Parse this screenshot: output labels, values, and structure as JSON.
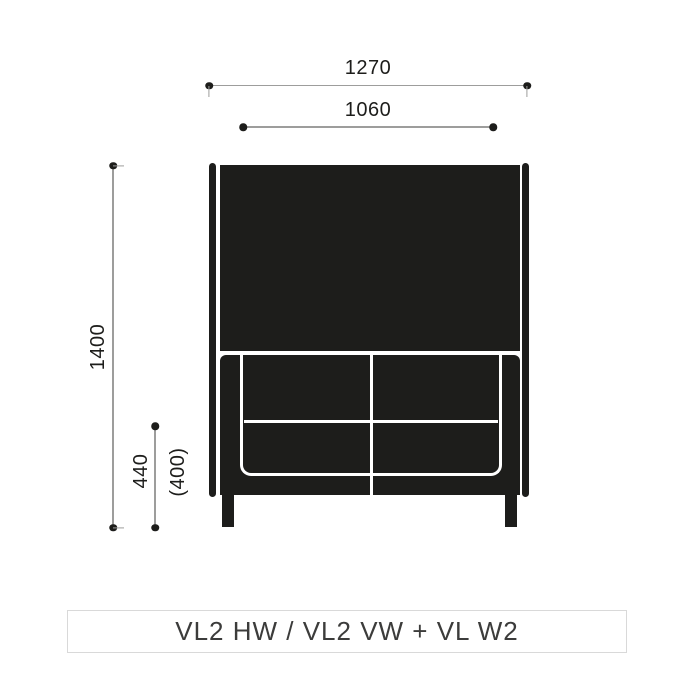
{
  "colors": {
    "ink": "#1d1d1b",
    "line": "#9d9d9c",
    "caption_text": "#3c3c3b",
    "caption_border": "#d9d9d9",
    "bg": "#ffffff"
  },
  "dimensions": {
    "width_total": "1270",
    "width_inner": "1060",
    "height_total": "1400",
    "seat_height": "440",
    "seat_height_alt": "(400)"
  },
  "caption": "VL2 HW / VL2 VW + VL W2"
}
